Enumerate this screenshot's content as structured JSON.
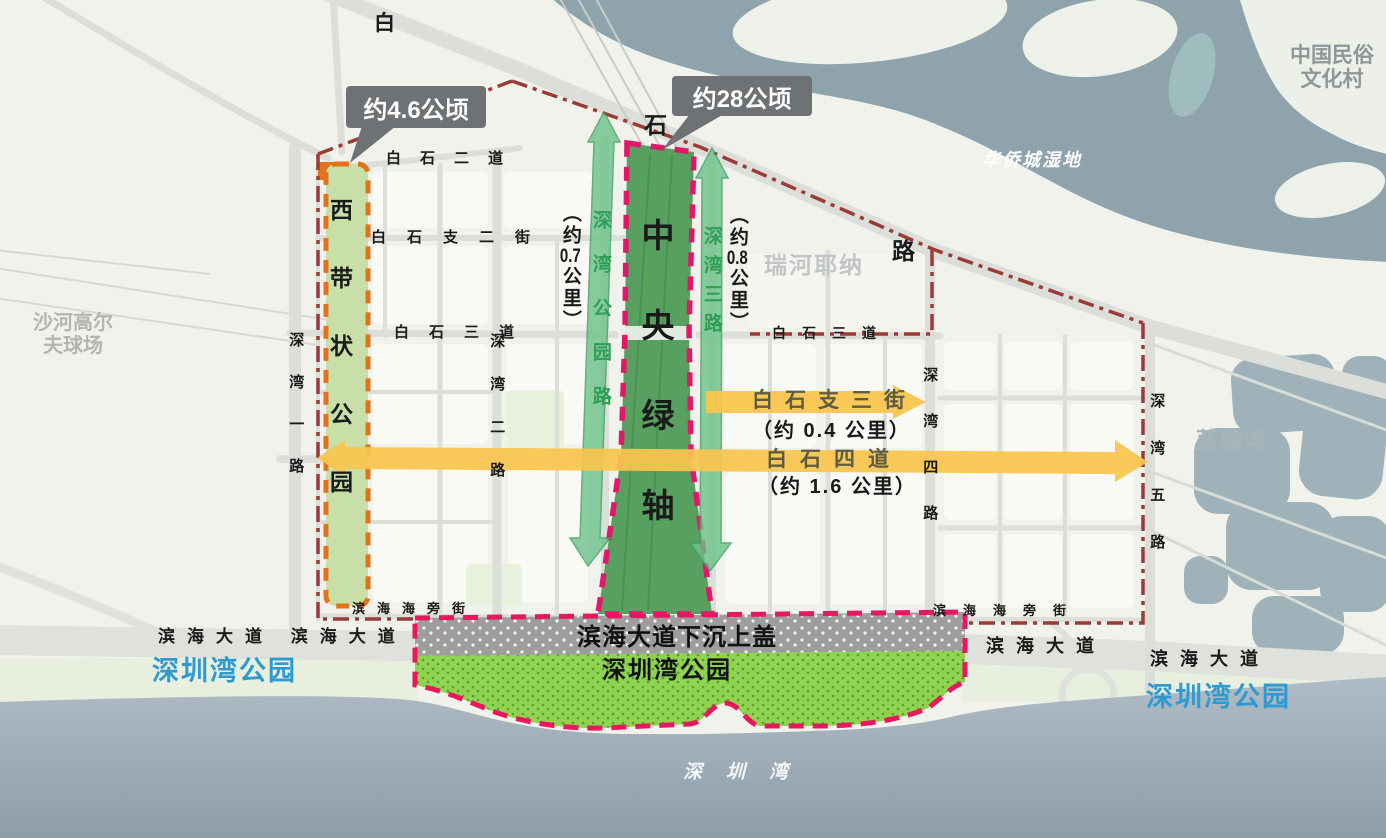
{
  "bubbles": {
    "west_area": "约4.6公顷",
    "axis_area": "约28公顷"
  },
  "areas": {
    "folk_village_line1": "中国民俗",
    "folk_village_line2": "文化村",
    "oct_wetland": "华侨城湿地",
    "golf_line1": "沙河高尔",
    "golf_line2": "夫球场",
    "ruihe_yena": "瑞河耶纳",
    "lanying_bay": "蓝楹湾",
    "shenzhen_bay": "深圳湾",
    "shenzhen_bay_park": "深圳湾公园"
  },
  "parks": {
    "west_belt": "西带状公园",
    "central_axis": "中央绿轴",
    "cover_plate": "滨海大道下沉上盖",
    "bay_park": "深圳湾公园"
  },
  "roads": {
    "bai": "白",
    "shi": "石",
    "lu": "路",
    "baishi_er_dao": "白石二道",
    "baishi_zhi_er_jie": "白石支二街",
    "baishi_san_dao": "白石三道",
    "binhai_haipang_jie": "滨海海旁街",
    "binhai_dadao": "滨海大道",
    "binhai_dadao_double": "滨海大道 滨海大道",
    "shenwan_yi_lu": "深湾一路",
    "shenwan_er_lu": "深湾二路",
    "shenwan_si_lu": "深湾四路",
    "shenwan_wu_lu": "深湾五路"
  },
  "measures": {
    "shenwan_park_road": "深湾公园路",
    "shenwan_park_road_len_parts": [
      "（约",
      "0.7",
      "公里）"
    ],
    "shenwan_san_lu": "深湾三路",
    "shenwan_san_lu_len_parts": [
      "（约",
      "0.8",
      "公里）"
    ],
    "baishi_zhi_san_jie": "白石支三街",
    "baishi_zhi_san_jie_len": "（约 0.4 公里）",
    "baishi_si_dao": "白石四道",
    "baishi_si_dao_len": "（约 1.6 公里）"
  },
  "colors": {
    "axis_green": "#57a05f",
    "axis_border_pink": "#e2176a",
    "arrow_green": "#6cc288",
    "arrow_yellow": "#f9c54d",
    "west_strip_green": "#c8e0a8",
    "west_strip_border_orange": "#e2731d",
    "outer_boundary_red": "#9c3a35",
    "bay_park_green": "#90d351",
    "cover_plate_gray": "#9d9e9c",
    "sea_blue_gray": "#9aa9b4",
    "bubble_gray": "#6e7275",
    "park_label_blue": "#2f9ad0",
    "measure_text_green": "#2f9e57"
  }
}
